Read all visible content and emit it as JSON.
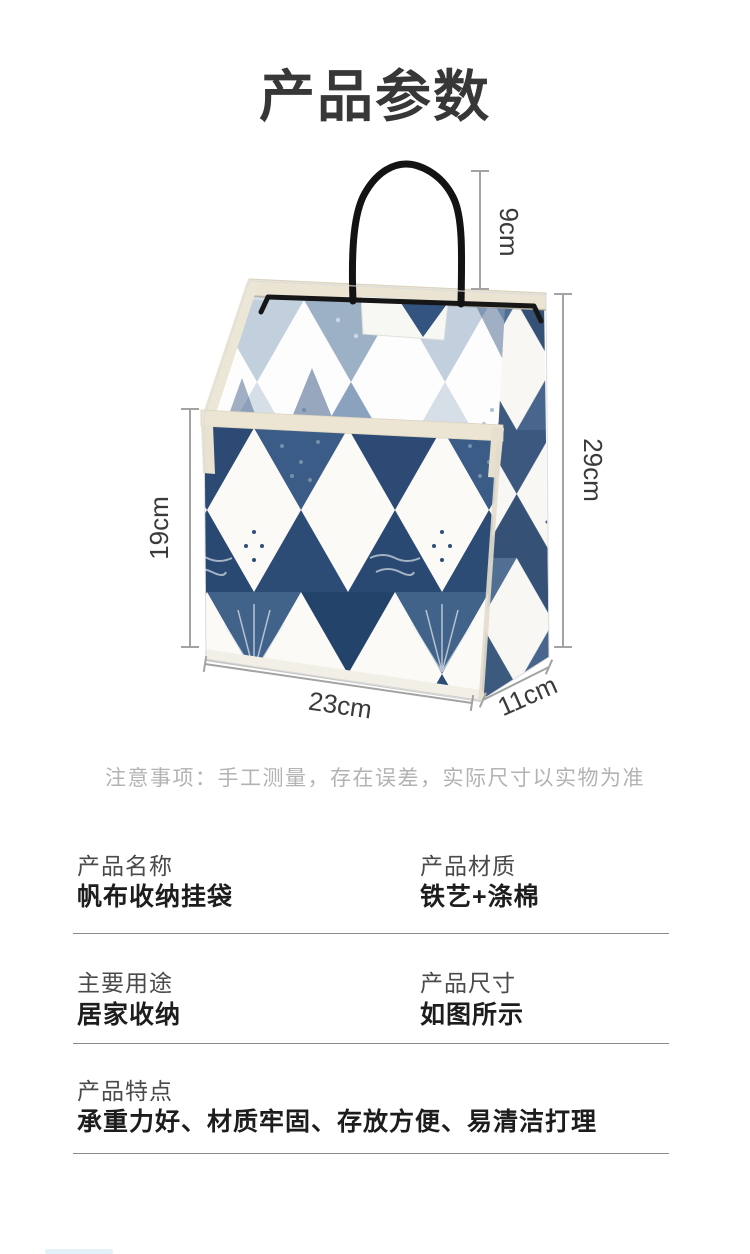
{
  "page": {
    "title": "产品参数",
    "note": "注意事项：手工测量，存在误差，实际尺寸以实物为准"
  },
  "product_figure": {
    "description": "canvas-hanging-storage-bag-with-triangle-pattern",
    "dimensions": {
      "handle_height": "9cm",
      "bag_height": "29cm",
      "pocket_height": "19cm",
      "bag_width": "23cm",
      "bag_depth": "11cm"
    }
  },
  "specs": [
    {
      "label": "产品名称",
      "value": "帆布收纳挂袋"
    },
    {
      "label": "产品材质",
      "value": "铁艺+涤棉"
    },
    {
      "label": "主要用途",
      "value": "居家收纳"
    },
    {
      "label": "产品尺寸",
      "value": "如图所示"
    },
    {
      "label": "产品特点",
      "value": "承重力好、材质牢固、存放方便、易清洁打理"
    }
  ],
  "colors": {
    "navy": "#2d4c75",
    "pattern_light_blue": "#b7c6d8",
    "trim_beige": "#ece5d4",
    "wire_black": "#161616",
    "dim_line": "#a3a3a3",
    "dim_text": "#3a3a3a",
    "title_text": "#373737",
    "note_text": "#b3b3b3",
    "divider": "#8a8a8a"
  }
}
